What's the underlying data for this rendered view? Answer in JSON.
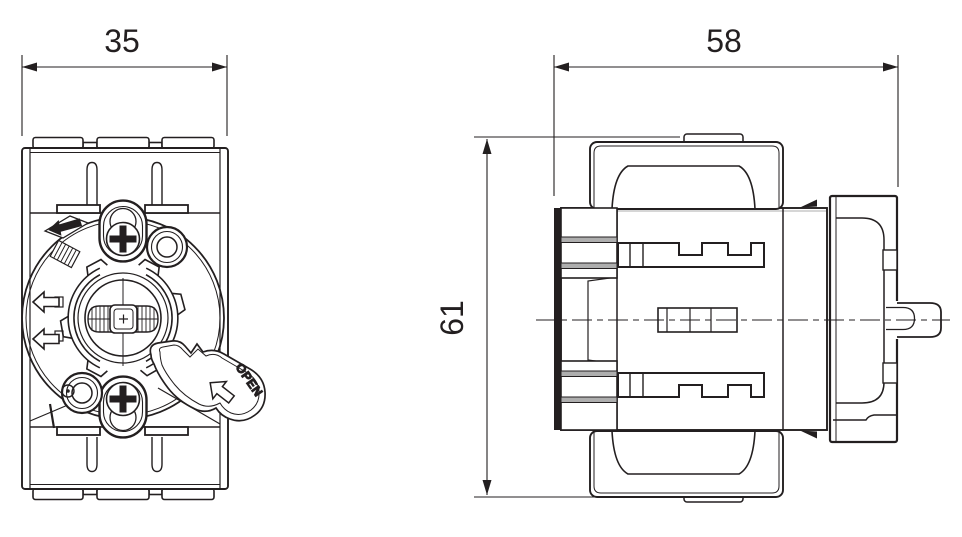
{
  "drawing": {
    "type": "technical-dimension-drawing",
    "views": {
      "front": {
        "width_dimension": "35",
        "lever_label": "OPEN"
      },
      "side": {
        "width_dimension": "58",
        "height_dimension": "61"
      }
    },
    "colors": {
      "background": "#ffffff",
      "line": "#231f20",
      "shade_gray": "#aeaeae"
    },
    "icons": {
      "dimension_arrows": "solid-triangle-arrowheads",
      "front_left_arrows": "open-left-arrow-icon",
      "front_padlock_mark": "key-circle-icon",
      "front_direction_mark": "solid-left-arrow-in-diamond-icon",
      "lever_arrow": "open-arrow-icon",
      "side_edge_marks": "half-arrow-icon"
    }
  }
}
